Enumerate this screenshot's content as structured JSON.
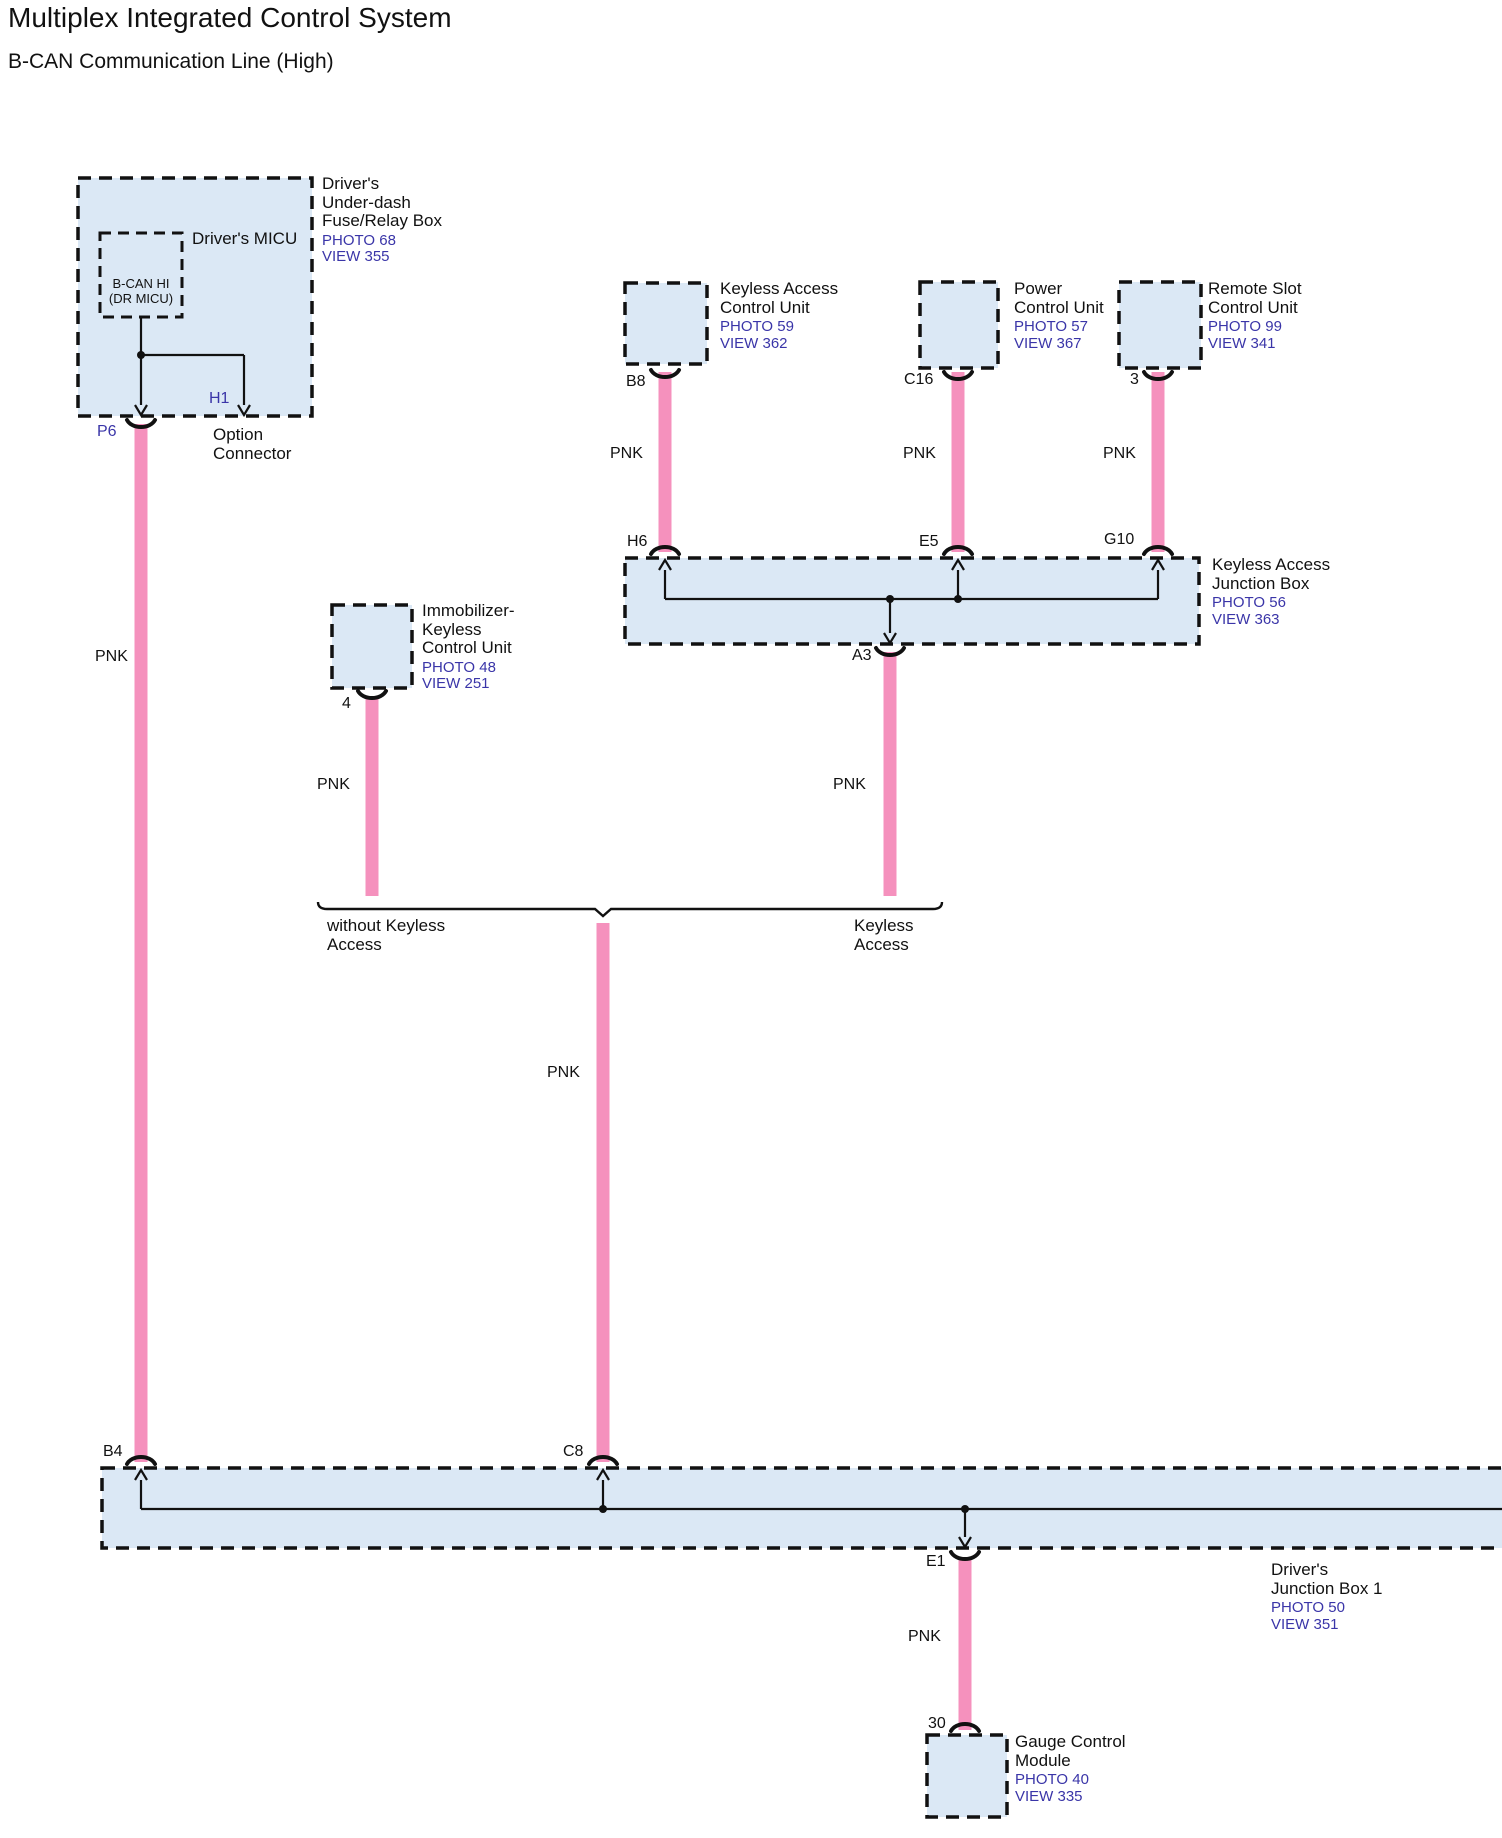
{
  "page": {
    "title": "Multiplex Integrated Control System",
    "subtitle": "B-CAN Communication Line (High)"
  },
  "colors": {
    "wire_pnk": "#F591BD",
    "box_fill": "#DBE8F5",
    "line": "#111111",
    "reference_text": "#3A35A8",
    "pin_highlight": "#3A35A8"
  },
  "wire": {
    "color_label": "PNK"
  },
  "components": {
    "fuse_relay_box": {
      "name_lines": [
        "Driver's",
        "Under-dash",
        "Fuse/Relay Box"
      ],
      "photo": "PHOTO 68",
      "view": "VIEW 355",
      "micu_label": "Driver's MICU",
      "bcan_node_lines": [
        "B-CAN HI",
        "(DR MICU)"
      ],
      "pin_p6": "P6",
      "pin_h1": "H1",
      "option_connector_lines": [
        "Option",
        "Connector"
      ]
    },
    "keyless_access_control_unit": {
      "name_lines": [
        "Keyless Access",
        "Control Unit"
      ],
      "photo": "PHOTO 59",
      "view": "VIEW 362",
      "pin": "B8"
    },
    "power_control_unit": {
      "name_lines": [
        "Power",
        "Control Unit"
      ],
      "photo": "PHOTO 57",
      "view": "VIEW 367",
      "pin": "C16"
    },
    "remote_slot_control_unit": {
      "name_lines": [
        "Remote Slot",
        "Control Unit"
      ],
      "photo": "PHOTO 99",
      "view": "VIEW 341",
      "pin": "3"
    },
    "keyless_access_junction_box": {
      "name_lines": [
        "Keyless Access",
        "Junction Box"
      ],
      "photo": "PHOTO 56",
      "view": "VIEW 363",
      "pin_h6": "H6",
      "pin_e5": "E5",
      "pin_g10": "G10",
      "pin_a3": "A3"
    },
    "immobilizer_keyless_control_unit": {
      "name_lines": [
        "Immobilizer-",
        "Keyless",
        "Control Unit"
      ],
      "photo": "PHOTO 48",
      "view": "VIEW 251",
      "pin": "4"
    },
    "drivers_junction_box_1": {
      "name_lines": [
        "Driver's",
        "Junction Box 1"
      ],
      "photo": "PHOTO 50",
      "view": "VIEW 351",
      "pin_b4": "B4",
      "pin_c8": "C8",
      "pin_e1": "E1"
    },
    "gauge_control_module": {
      "name_lines": [
        "Gauge Control",
        "Module"
      ],
      "photo": "PHOTO 40",
      "view": "VIEW 335",
      "pin": "30"
    }
  },
  "branch_labels": {
    "without_keyless_lines": [
      "without Keyless",
      "Access"
    ],
    "keyless_lines": [
      "Keyless",
      "Access"
    ]
  }
}
